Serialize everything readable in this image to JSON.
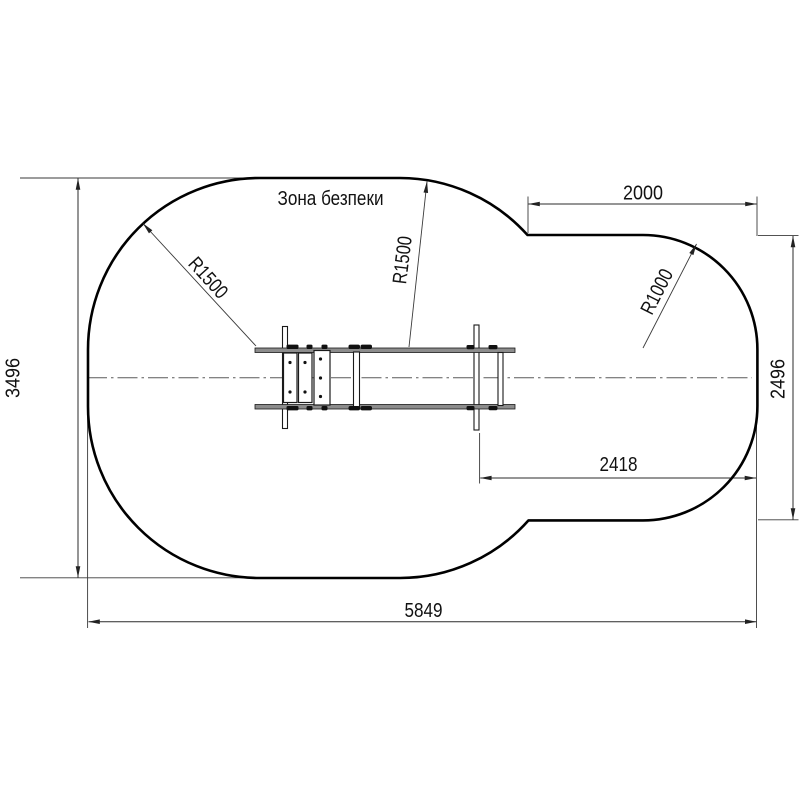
{
  "drawing": {
    "safety_zone_label": "Зона безпеки",
    "dimensions": {
      "overall_width": "5849",
      "overall_height": "3496",
      "right_section_width": "2000",
      "right_section_height": "2496",
      "equipment_to_edge": "2418"
    },
    "radii": {
      "left": "R1500",
      "middle": "R1500",
      "right": "R1000"
    }
  },
  "colors": {
    "background": "#ffffff",
    "outline": "#000000",
    "dimension_lines": "#3a3a3a",
    "rail_fill": "#8c8c8c",
    "text": "#111111"
  }
}
